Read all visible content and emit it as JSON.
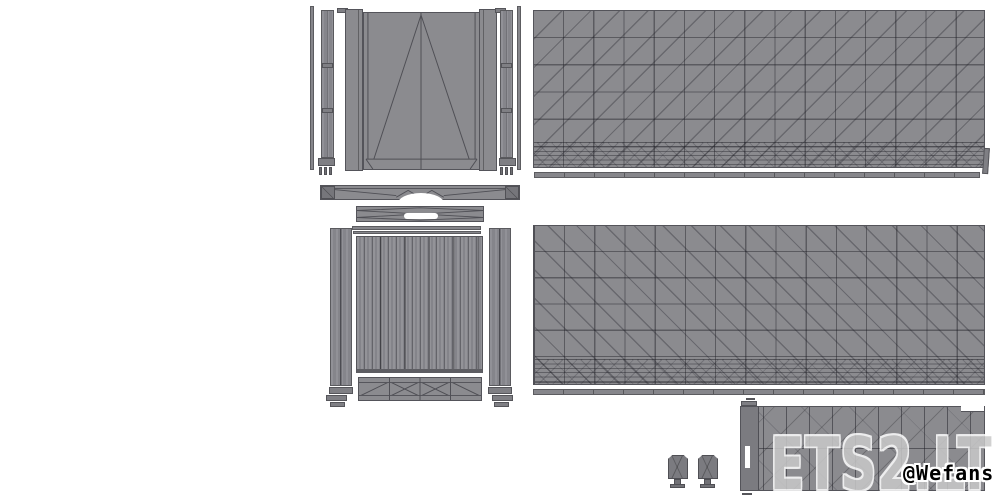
{
  "meta": {
    "title": "Trailer mod wireframe parts layout",
    "width": 1000,
    "height": 500
  },
  "watermarks": {
    "site": "ETS2.LT",
    "author": "@Wefans"
  },
  "palette": {
    "page_bg": "#ffffff",
    "panel_fill": "#8b8b8f",
    "panel_line": "#54545a",
    "pillar_fill": "#85858b",
    "strip_fill": "#86868b",
    "floor_fill": "#84848a",
    "dark_part": "#77777c",
    "watermark_gray": "#c9c9c9",
    "author_text": "#000000",
    "outline": "#ffffff"
  },
  "parts": {
    "rear_doors": "rear-door-panel",
    "side_wall_top": "side-wall-panel-top",
    "side_wall_bottom": "side-wall-panel-bottom",
    "floor": "floor-plank-panel",
    "roof": "roof-panel",
    "pillars": "corner-pillars",
    "bumper": "rear-bumper-bar",
    "crossmember": "crossmember-bar",
    "mudflaps": "mudflap-pair"
  }
}
